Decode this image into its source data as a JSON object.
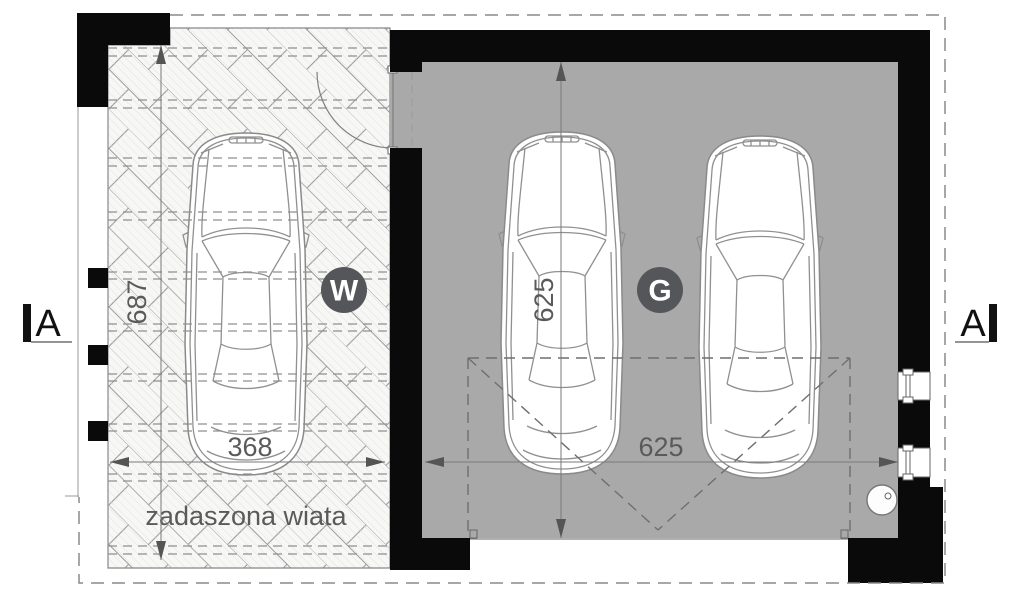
{
  "drawing": {
    "title": "garage-and-carport-floor-plan",
    "section_markers": {
      "left": "A",
      "right": "A"
    },
    "rooms": {
      "carport": {
        "symbol": "W",
        "label": "zadaszona wiata",
        "width_dim": "368",
        "depth_dim": "687"
      },
      "garage": {
        "symbol": "G",
        "width_dim": "625",
        "depth_dim": "625"
      }
    },
    "colors": {
      "wall": "#0a0a0a",
      "garage_floor": "#a9a9a9",
      "badge": "#55565a",
      "dim_text": "#5a5a5a"
    }
  }
}
